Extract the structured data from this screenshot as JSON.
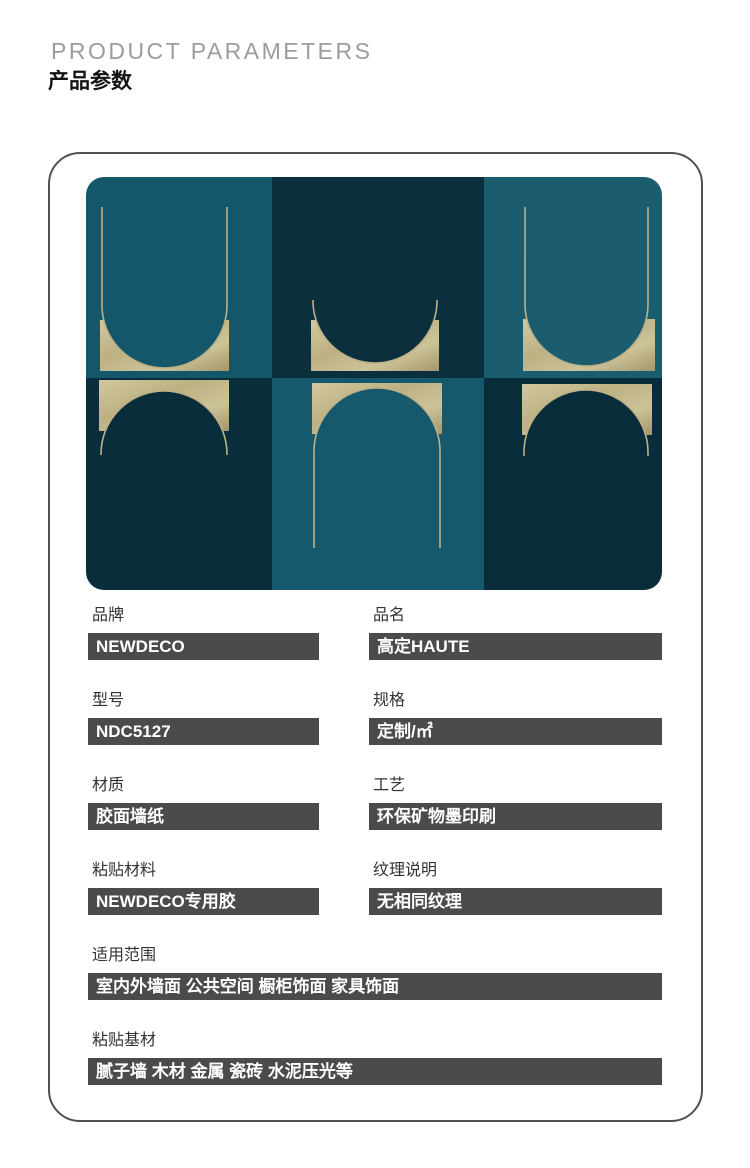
{
  "header": {
    "title_en": "PRODUCT PARAMETERS",
    "title_zh": "产品参数"
  },
  "product_image": {
    "alt": "Six-panel art-deco wallpaper: teal and dark navy squares with gold foil U-arches and domes",
    "colors": {
      "teal_top_left": "#14566a",
      "teal_top_right": "#1b5d6e",
      "teal_bottom_mid": "#17596c",
      "navy_top_mid": "#0c2f3e",
      "navy_bottom_left": "#0a2d3b",
      "navy_bottom_right": "#092c3a",
      "gold": "#c1b78a",
      "gold_line": "#bcb084"
    }
  },
  "parameters": {
    "fields": [
      {
        "label": "品牌",
        "value": "NEWDECO"
      },
      {
        "label": "品名",
        "value": "高定HAUTE"
      },
      {
        "label": "型号",
        "value": "NDC5127"
      },
      {
        "label": "规格",
        "value": "定制/㎡"
      },
      {
        "label": "材质",
        "value": "胶面墙纸"
      },
      {
        "label": "工艺",
        "value": "环保矿物墨印刷"
      },
      {
        "label": "粘贴材料",
        "value": "NEWDECO专用胶"
      },
      {
        "label": "纹理说明",
        "value": "无相同纹理"
      },
      {
        "label": "适用范围",
        "value": "室内外墙面 公共空间 橱柜饰面 家具饰面"
      },
      {
        "label": "粘贴基材",
        "value": "腻子墙 木材 金属 瓷砖 水泥压光等"
      }
    ]
  },
  "style": {
    "value_bar_bg": "#4b4b4b",
    "frame_border": "#515154",
    "title_gray": "#9c9c9c"
  }
}
